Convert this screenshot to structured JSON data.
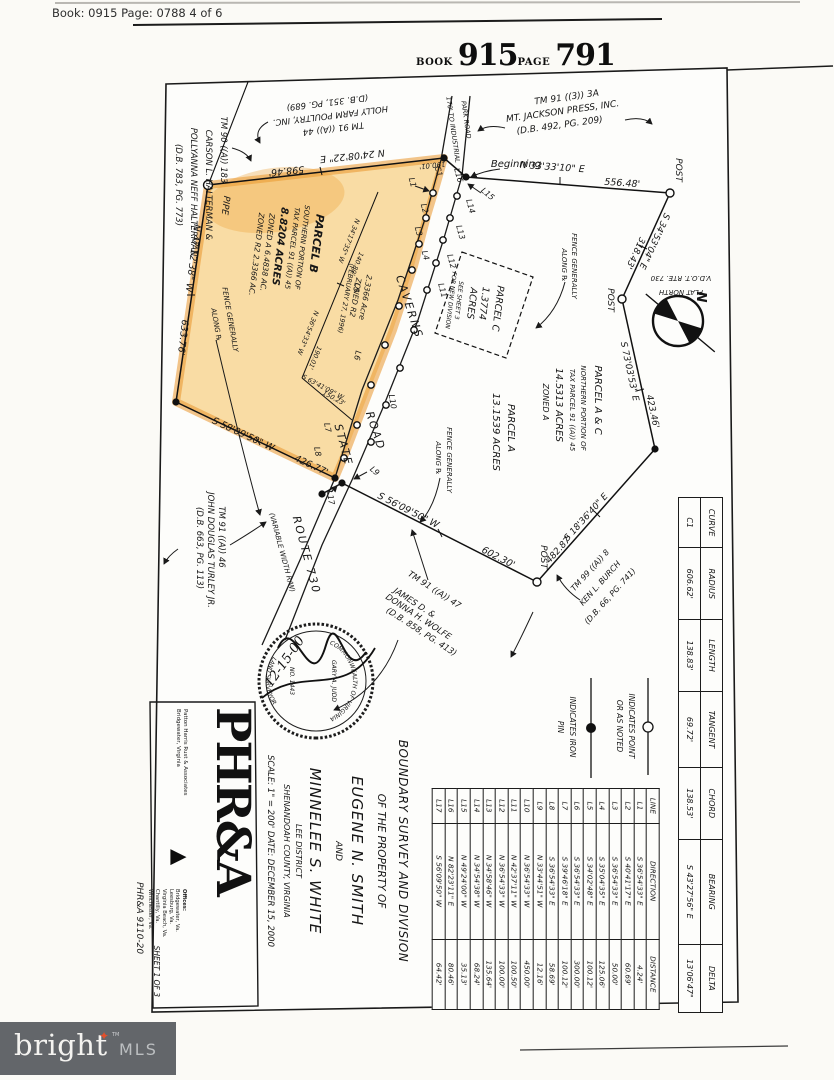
{
  "header": {
    "book_line": "Book: 0915 Page: 0788 4 of 6"
  },
  "book_stamp": {
    "book_label": "BOOK",
    "book_num": "915",
    "page_label": "PAGE",
    "page_num": "791"
  },
  "adjoiners": {
    "halterman": [
      "TM 90 ((A)) 183",
      "CARSON L. HALTERMAN &",
      "POLLYANNA NEFF HALTERMAN",
      "(D.B. 783, PG. 773)"
    ],
    "holly_farm": [
      "TM 91 ((A)) 44",
      "HOLLY FARM POULTRY, INC.",
      "(D.B. 351, PG. 689)"
    ],
    "mt_jackson": [
      "TM 91 ((3)) 3A",
      "MT. JACKSON PRESS, INC.",
      "(D.B. 492, PG. 209)"
    ],
    "burch": [
      "TM 99 ((A)) 8",
      "KEN L. BURCH",
      "(D.B. 66, PG. 741)"
    ],
    "wolfe": [
      "TM 91 ((A)) 47",
      "JAMES D. &",
      "DONNA H. WOLFE",
      "(D.B. 858, PG. 413)"
    ],
    "turley": [
      "TM 91 ((A)) 46",
      "JOHN DOUGLAS TURLEY JR.",
      "(D.B. 663, PG. 113)"
    ]
  },
  "parcels": {
    "b": [
      "PARCEL B",
      "SOUTHERN PORTION OF",
      "TAX PARCEL 91 ((A)) 45",
      "8.8204 ACRES",
      "ZONED A    6.4838 AC.",
      "ZONED R2   2.3366 AC."
    ],
    "b_r2": [
      "2.3366 Acre",
      "ZONED R2",
      "(FEBRUARY 27, 1996)"
    ],
    "c": [
      "PARCEL C",
      "1.3774",
      "ACRES",
      "SEE SHEET 3",
      "FOR NEW DIVISION"
    ],
    "ac": [
      "PARCEL A & C",
      "NORTHERN PORTION OF",
      "TAX PARCEL 91 ((A)) 45",
      "14.5313 ACRES",
      "ZONED A"
    ],
    "a": [
      "PARCEL A",
      "13.1539 ACRES"
    ]
  },
  "plat": {
    "pipe": "PIPE",
    "post": "POST",
    "beginning": "Beginning",
    "b598": "N 24'08'22\" E",
    "d598": "598.46'",
    "d190": "190.01'",
    "b556": "N 33'33'10\" E",
    "d556": "556.48'",
    "b318": "S 34'53'04\" E",
    "d318": "318.43'",
    "b423": "S 73'03'53\" E",
    "d423": "423.46'",
    "b482": "S 18'36'40\" E",
    "d482": "482.87'",
    "b602": "S 56'09'50\" W",
    "d602": "602.30'",
    "b426": "S 58'09'50\" W",
    "d426": "426.77'",
    "b633": "N 47'12'38\" W",
    "d633": "633.76'",
    "bi1": "N 34'17'35\" W",
    "di1": "140.89'",
    "bi2": "N 36'54'33\" W",
    "di2": "190.01'",
    "bi3": "S 63'41'09\" W",
    "di3": "150.23'",
    "road_to": "170' TO INDUSTRIAL",
    "road_to2": "PARK ROAD",
    "caverns": "CAVERNS",
    "road_word": "ROAD",
    "state": "STATE",
    "route": "ROUTE 730",
    "variable": "(VARIABLE WIDTH R/W)",
    "fence1": "FENCE GENERALLY",
    "fence2": "ALONG ℞"
  },
  "north": {
    "n": "N",
    "plat_north": "PLAT NORTH",
    "vdot": "V.D.O.T. RTE. 730"
  },
  "legend": {
    "point1": "INDICATES POINT",
    "point2": "OR AS NOTED",
    "iron1": "INDICATES IRON",
    "iron2": "PIN"
  },
  "curve_table": {
    "headers": [
      "CURVE",
      "RADIUS",
      "LENGTH",
      "TANGENT",
      "CHORD",
      "BEARING",
      "DELTA"
    ],
    "rows": [
      [
        "C1",
        "606.62'",
        "138.83'",
        "69.72'",
        "138.53'",
        "S 43'27'56\" E",
        "13'06'47\""
      ]
    ]
  },
  "line_table": {
    "headers": [
      "LINE",
      "DIRECTION",
      "DISTANCE"
    ],
    "rows": [
      [
        "L1",
        "S 36'54'33\" E",
        "4.24'"
      ],
      [
        "L2",
        "S 40'41'17\" E",
        "60.69'"
      ],
      [
        "L3",
        "S 36'54'33\" E",
        "50.00'"
      ],
      [
        "L4",
        "S 35'04'35\" E",
        "125.06'"
      ],
      [
        "L5",
        "S 34'02'48\" E",
        "100.12'"
      ],
      [
        "L6",
        "S 36'54'33\" E",
        "300.00'"
      ],
      [
        "L7",
        "S 39'46'18\" E",
        "100.12'"
      ],
      [
        "L8",
        "S 36'54'33\" E",
        "58.69'"
      ],
      [
        "L9",
        "N 33'44'51\" W",
        "12.16'"
      ],
      [
        "L10",
        "N 36'54'33\" W",
        "450.00'"
      ],
      [
        "L11",
        "N 42'37'11\" W",
        "100.50'"
      ],
      [
        "L12",
        "N 36'54'33\" W",
        "100.00'"
      ],
      [
        "L13",
        "N 34'58'46\" W",
        "135.64'"
      ],
      [
        "L14",
        "N 34'54'38\" W",
        "68.24'"
      ],
      [
        "L15",
        "N 49'24'00\" W",
        "35.13'"
      ],
      [
        "L16",
        "N 82'23'11\" E",
        "80.46'"
      ],
      [
        "L17",
        "S 56'09'50\" W",
        "64.42'"
      ]
    ]
  },
  "title_block": {
    "l1": "BOUNDARY SURVEY AND DIVISION",
    "l2": "OF THE PROPERTY OF",
    "name1": "EUGENE N. SMITH",
    "and": "AND",
    "name2": "MINNELEE S. WHITE",
    "district": "LEE DISTRICT",
    "county": "SHENANDOAH COUNTY, VIRGINIA",
    "scale_date": "SCALE: 1\" = 200'   DATE: DECEMBER 15, 2000"
  },
  "seal": {
    "arc_top": "COMMONWEALTH OF VIRGINIA",
    "arc_bottom": "LAND SURVEYOR",
    "name": "GARY A. JUDD",
    "number": "NO. 1443",
    "date": "12-15-00"
  },
  "phra": {
    "logo": "PHR&A",
    "firm1": "Patton Harris Rust & Associates",
    "firm2": "Bridgewater, Virginia",
    "offices_label": "Offices:",
    "offices": "Bridgewater, Va.\nLeesburg, Va.\nVirginia Beach, Va.\nChantilly, Va.\nWinchester, Va.",
    "sheet": "SHEET 1 OF 3",
    "job": "PHR&A 9110-20"
  },
  "mls": {
    "brand": "bright",
    "suffix": "MLS",
    "tm": "TM"
  }
}
